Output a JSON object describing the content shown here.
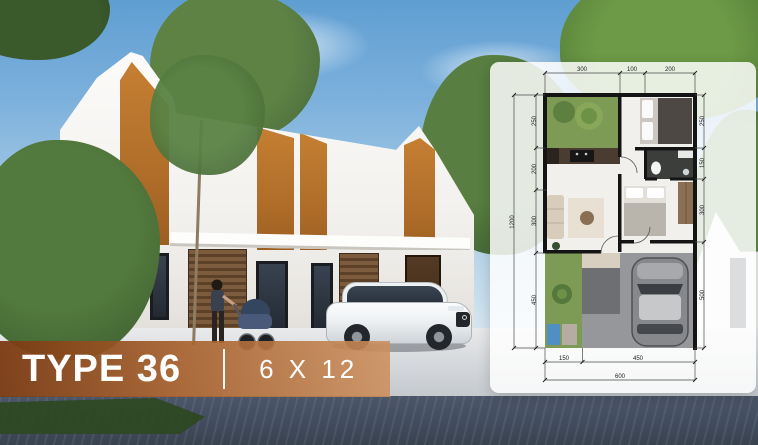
{
  "banner": {
    "type_label": "TYPE 36",
    "size_label": "6 X 12"
  },
  "floorplan": {
    "dims_top": [
      "300",
      "100",
      "200"
    ],
    "dims_left": [
      "250",
      "200",
      "300",
      "450"
    ],
    "dim_left_total": "1200",
    "dims_right": [
      "250",
      "150",
      "300",
      "500"
    ],
    "dims_bottom": [
      "150",
      "450"
    ],
    "dim_bottom_total": "600"
  },
  "colors": {
    "accent_orange": "#b06e29",
    "banner_gradient_left": "#7a3a12",
    "banner_gradient_right": "#cd8f5c",
    "sky_top": "#5f9ed2",
    "road": "#414c5e",
    "plan_wall": "#141414",
    "garden_green": "#7d9b55"
  }
}
